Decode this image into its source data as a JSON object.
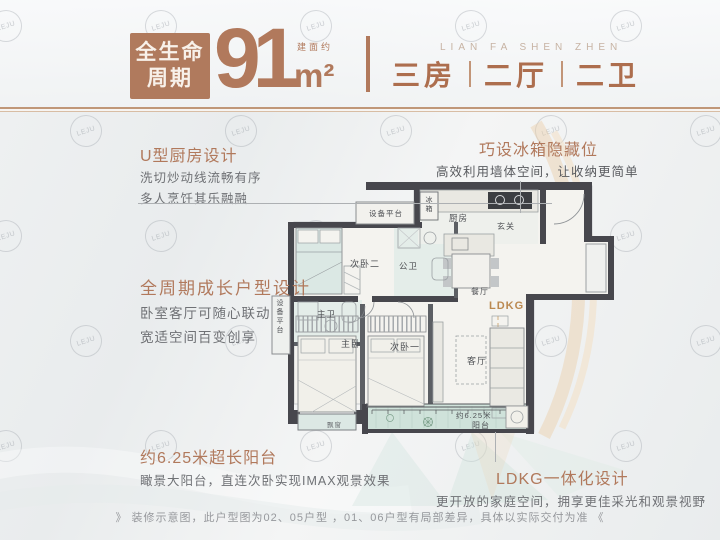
{
  "colors": {
    "accent_brown": "#b1795c",
    "spec_brown": "#ad6e4e",
    "wall_dark": "#47474d",
    "wet_room_teal": "#e4ede9",
    "balcony_teal": "#cfe2da",
    "arc_orange": "#eccfa9",
    "ldkg_text": "#bb8950"
  },
  "watermark": {
    "text": "LEJU"
  },
  "header": {
    "badge": {
      "line1": "全生命",
      "line2": "周期"
    },
    "area": {
      "prefix": "建面约",
      "number": "91",
      "unit": "m²"
    },
    "brand": "LIAN FA SHEN ZHEN",
    "specs": [
      "三房",
      "二厅",
      "二卫"
    ]
  },
  "annotations": {
    "kitchen": {
      "title": "U型厨房设计",
      "lines": [
        "洗切炒动线流畅有序",
        "多人烹饪其乐融融"
      ]
    },
    "fridge": {
      "title": "巧设冰箱隐藏位",
      "line": "高效利用墙体空间，让收纳更简单"
    },
    "growth": {
      "title": "全周期成长户型设计",
      "lines": [
        "卧室客厅可随心联动",
        "宽适空间百变创享"
      ]
    },
    "balcony": {
      "title": "约6.25米超长阳台",
      "line": "瞰景大阳台，直连次卧实现IMAX观景效果"
    },
    "ldkg": {
      "title": "LDKG一体化设计",
      "line": "更开放的家庭空间，拥享更佳采光和观景视野"
    }
  },
  "floorplan": {
    "labels": {
      "equip_top": "设备平台",
      "fridge": "冰箱",
      "kitchen": "厨房",
      "entry": "玄关",
      "bedroom2": "次卧二",
      "bath_public": "公卫",
      "dining": "餐厅",
      "ldkg": "LDKG",
      "bath_master": "主卫",
      "equip_left": "设备平台",
      "master_bedroom": "主卧",
      "bedroom1": "次卧一",
      "living": "客厅",
      "bay_window": "飘窗",
      "balcony_length": "约6.25米",
      "balcony": "阳台"
    }
  },
  "footer": {
    "disclaimer": "》 装修示意图，此户型图为02、05户型 ，01、06户型有局部差异，具体以实际交付为准 《"
  }
}
